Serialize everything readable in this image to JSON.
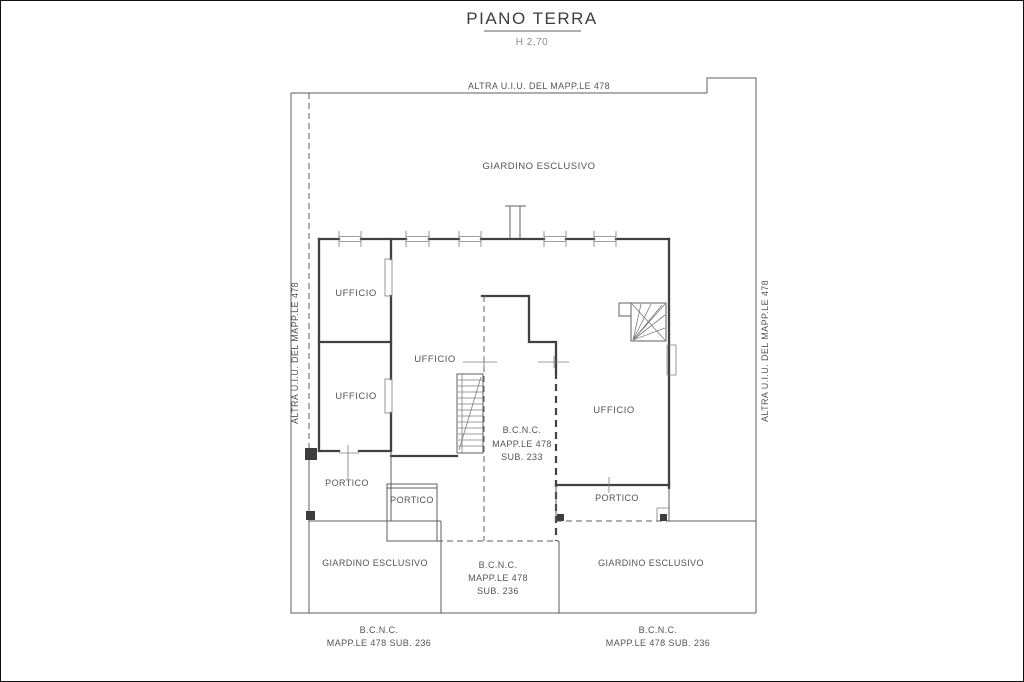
{
  "title": {
    "text": "PIANO TERRA",
    "height_note": "H 2,70"
  },
  "boundary_labels": {
    "top": "ALTRA U.I.U. DEL MAPP.LE 478",
    "left": "ALTRA U.I.U. DEL MAPP.LE 478",
    "right": "ALTRA U.I.U. DEL MAPP.LE 478"
  },
  "rooms": {
    "garden_top": "GIARDINO ESCLUSIVO",
    "office_upper_left": "UFFICIO",
    "office_center": "UFFICIO",
    "office_lower_left": "UFFICIO",
    "office_right": "UFFICIO",
    "portico_left": "PORTICO",
    "portico_center": "PORTICO",
    "portico_right": "PORTICO",
    "bcnc_center": {
      "line1": "B.C.N.C.",
      "line2": "MAPP.LE 478",
      "line3": "SUB. 233"
    },
    "garden_bottom_left": "GIARDINO ESCLUSIVO",
    "garden_bottom_right": "GIARDINO ESCLUSIVO",
    "bcnc_bottom": {
      "line1": "B.C.N.C.",
      "line2": "MAPP.LE 478",
      "line3": "SUB. 236"
    }
  },
  "footer_labels": {
    "left": {
      "line1": "B.C.N.C.",
      "line2": "MAPP.LE 478 SUB. 236"
    },
    "right": {
      "line1": "B.C.N.C.",
      "line2": "MAPP.LE 478 SUB. 236"
    }
  },
  "colors": {
    "line": "#414141",
    "text": "#545454",
    "background": "#ffffff"
  }
}
